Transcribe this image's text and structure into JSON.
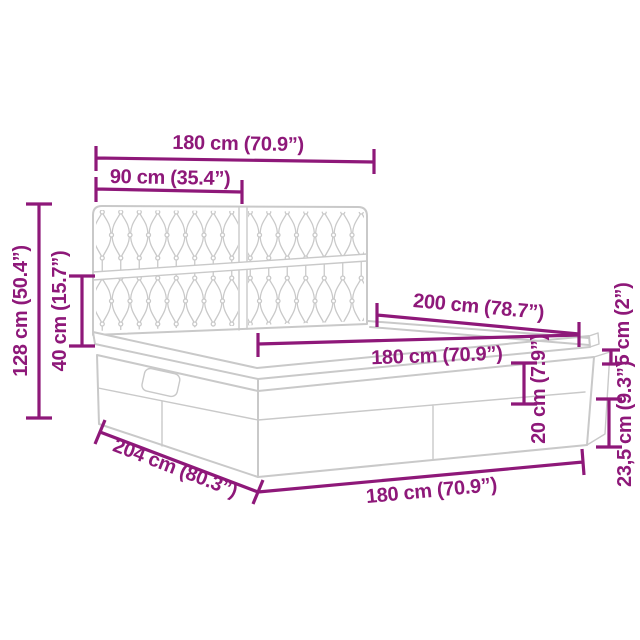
{
  "colors": {
    "dimension_lines": "#8E1879",
    "artwork_lines": "#C9C9C9",
    "background": "#FFFFFF"
  },
  "dimensions": {
    "headboard_width": "180 cm (70.9”)",
    "headboard_half_width": "90 cm (35.4”)",
    "total_height": "128 cm (50.4”)",
    "headboard_lower_height": "40 cm (15.7”)",
    "bed_length": "200 cm (78.7”)",
    "mattress_width": "180 cm (70.9”)",
    "top_frame_height": "5 cm (2”)",
    "mattress_height": "20 cm (7.9”)",
    "base_height": "23,5 cm (9.3”)",
    "total_length": "204 cm (80.3”)",
    "base_width": "180 cm (70.9”)"
  }
}
